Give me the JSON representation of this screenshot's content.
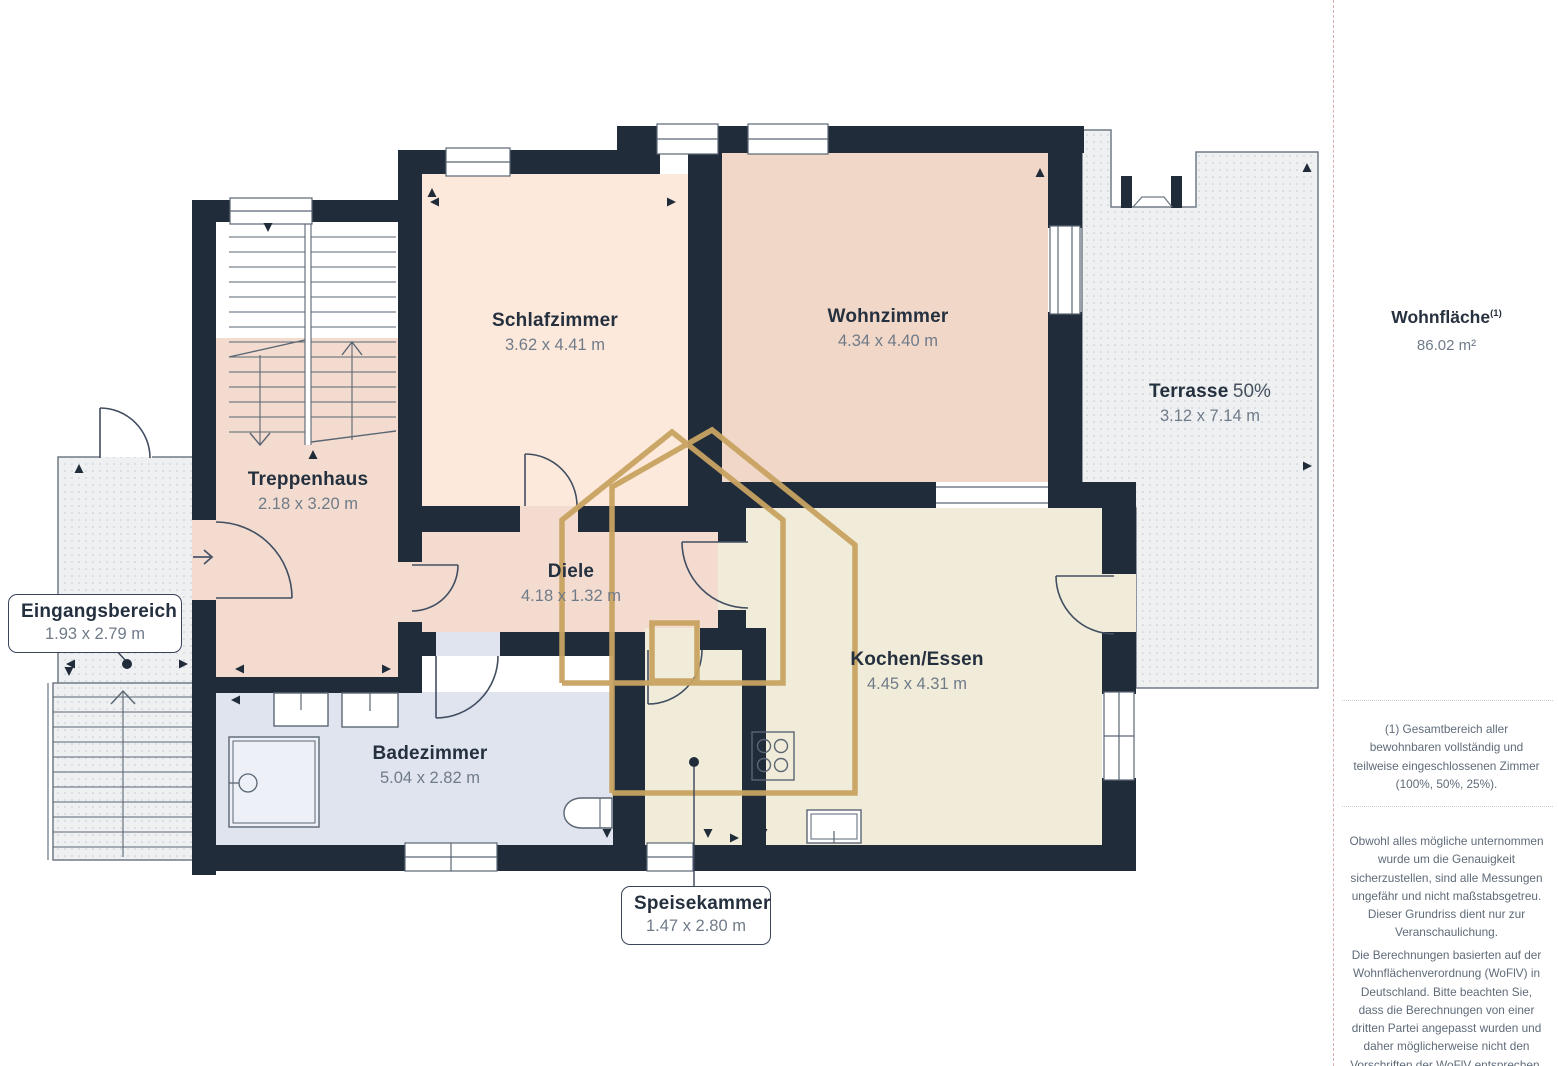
{
  "floorplan": {
    "rooms": [
      {
        "id": "schlafzimmer",
        "name": "Schlafzimmer",
        "dims": "3.62 x 4.41 m"
      },
      {
        "id": "wohnzimmer",
        "name": "Wohnzimmer",
        "dims": "4.34 x 4.40 m"
      },
      {
        "id": "terrasse",
        "name": "Terrasse",
        "share": "50%",
        "dims": "3.12 x 7.14 m"
      },
      {
        "id": "treppenhaus",
        "name": "Treppenhaus",
        "dims": "2.18 x 3.20 m"
      },
      {
        "id": "diele",
        "name": "Diele",
        "dims": "4.18 x 1.32 m"
      },
      {
        "id": "kochen-essen",
        "name": "Kochen/Essen",
        "dims": "4.45 x 4.31 m"
      },
      {
        "id": "badezimmer",
        "name": "Badezimmer",
        "dims": "5.04 x 2.82 m"
      },
      {
        "id": "eingangsbereich",
        "name": "Eingangsbereich",
        "dims": "1.93 x 2.79 m"
      },
      {
        "id": "speisekammer",
        "name": "Speisekammer",
        "dims": "1.47 x 2.80 m"
      }
    ],
    "colors": {
      "wall": "#212c3a",
      "room_peach": "#fde9db",
      "room_rose": "#f0d7c8",
      "room_rose_light": "#f3dccf",
      "room_cream": "#f1ecd9",
      "room_bath": "#dfe4ef",
      "outdoor_dotted": "#eef0f1",
      "watermark_gold": "#c8a361",
      "title_text": "#25303f",
      "dims_text": "#707b89"
    }
  },
  "sidebar": {
    "area_title": "Wohnfläche",
    "area_sup": "(1)",
    "area_value": "86.02 m²",
    "footnote": "(1) Gesamtbereich aller bewohnbaren vollständig und teilweise eingeschlossenen Zimmer (100%, 50%, 25%).",
    "disclaimer1": "Obwohl alles mögliche unternommen wurde um die Genauigkeit sicherzustellen, sind alle Messungen ungefähr und nicht maßstabsgetreu. Dieser Grundriss dient nur zur Veranschaulichung.",
    "disclaimer2": "Die Berechnungen basierten auf der Wohnflächenverordnung (WoFlV) in Deutschland. Bitte beachten Sie, dass die Berechnungen von einer dritten Partei angepasst wurden und daher möglicherweise nicht den Vorschriften der WoFlV entsprechen."
  }
}
